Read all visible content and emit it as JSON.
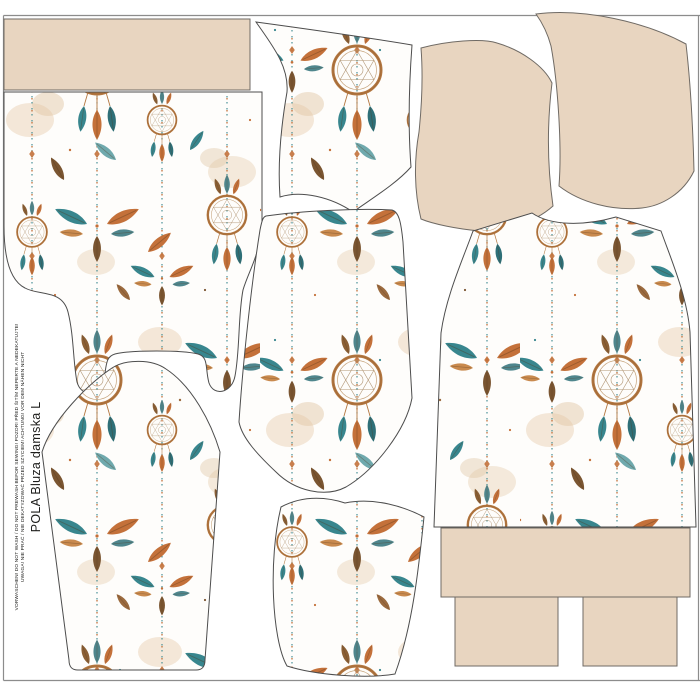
{
  "panel": {
    "title": "POLA Bluza damska L",
    "care_line_1": "UWAGA! NIE PRAĆ / NIE DEKATYZOWAĆ PRZED SZYCIEM! ACHTUNG! VOR DEM NÄHEN NICHT",
    "care_line_2": "VORWASCHEN! DO NOT WASH / DO NOT PREWASH BEFOR SEWING! POZOR! PŘED ŠITÍM NEPERTE A NEDEKATUJTE!"
  },
  "colors": {
    "page_background": "#ffffff",
    "solid_fabric_beige": "#e8d5c0",
    "piece_outline": "#4d4d4d",
    "frame_border": "#8c8c8c",
    "fabric_base_white": "#fefdfb",
    "dreamcatcher_ring_brown": "#b3763f",
    "feather_teal": "#38868e",
    "feather_orange": "#c4713a",
    "feather_brown": "#7a5531",
    "watercolor_tan": "#ead5bc",
    "text_color": "#1d1d1b"
  }
}
